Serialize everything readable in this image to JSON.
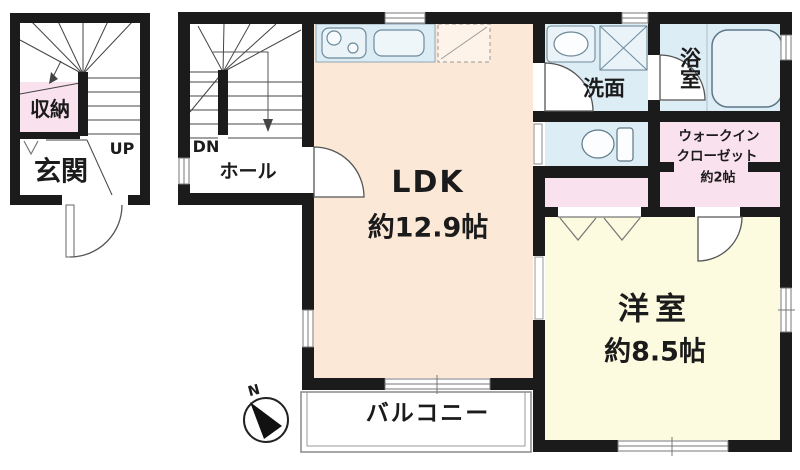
{
  "floor1": {
    "storage": "収納",
    "entrance": "玄関",
    "up": "UP"
  },
  "floor2": {
    "dn": "DN",
    "hall": "ホール",
    "ldk": {
      "name": "LDK",
      "size": "約12.9帖"
    },
    "washroom": "洗面",
    "bathroom": "浴室",
    "wic": {
      "line1": "ウォークイン",
      "line2": "クローゼット",
      "size": "約2帖"
    },
    "bedroom": {
      "name": "洋室",
      "size": "約8.5帖"
    },
    "balcony": "バルコニー"
  },
  "compass": {
    "north": "N"
  },
  "colors": {
    "wall": "#1b1b1b",
    "ldk_floor": "#fbe8d7",
    "bedroom_floor": "#fcfadf",
    "closet_pink": "#f9e1ed",
    "wet_area_blue": "#ddedf5",
    "fixture_blue": "#e9f3f8",
    "line_gray": "#555555"
  },
  "icons": {
    "stove": "stove-icon",
    "kitchen_sink": "sink-icon",
    "refrigerator_space": "refrigerator-space-icon",
    "vanity_sink": "vanity-sink-icon",
    "washing_machine": "washing-machine-icon",
    "bathtub": "bathtub-icon",
    "toilet": "toilet-icon",
    "stairs_up": "stairs-up-icon",
    "stairs_down": "stairs-down-icon",
    "door_swing": "door-arc-icon",
    "compass": "compass-icon"
  }
}
